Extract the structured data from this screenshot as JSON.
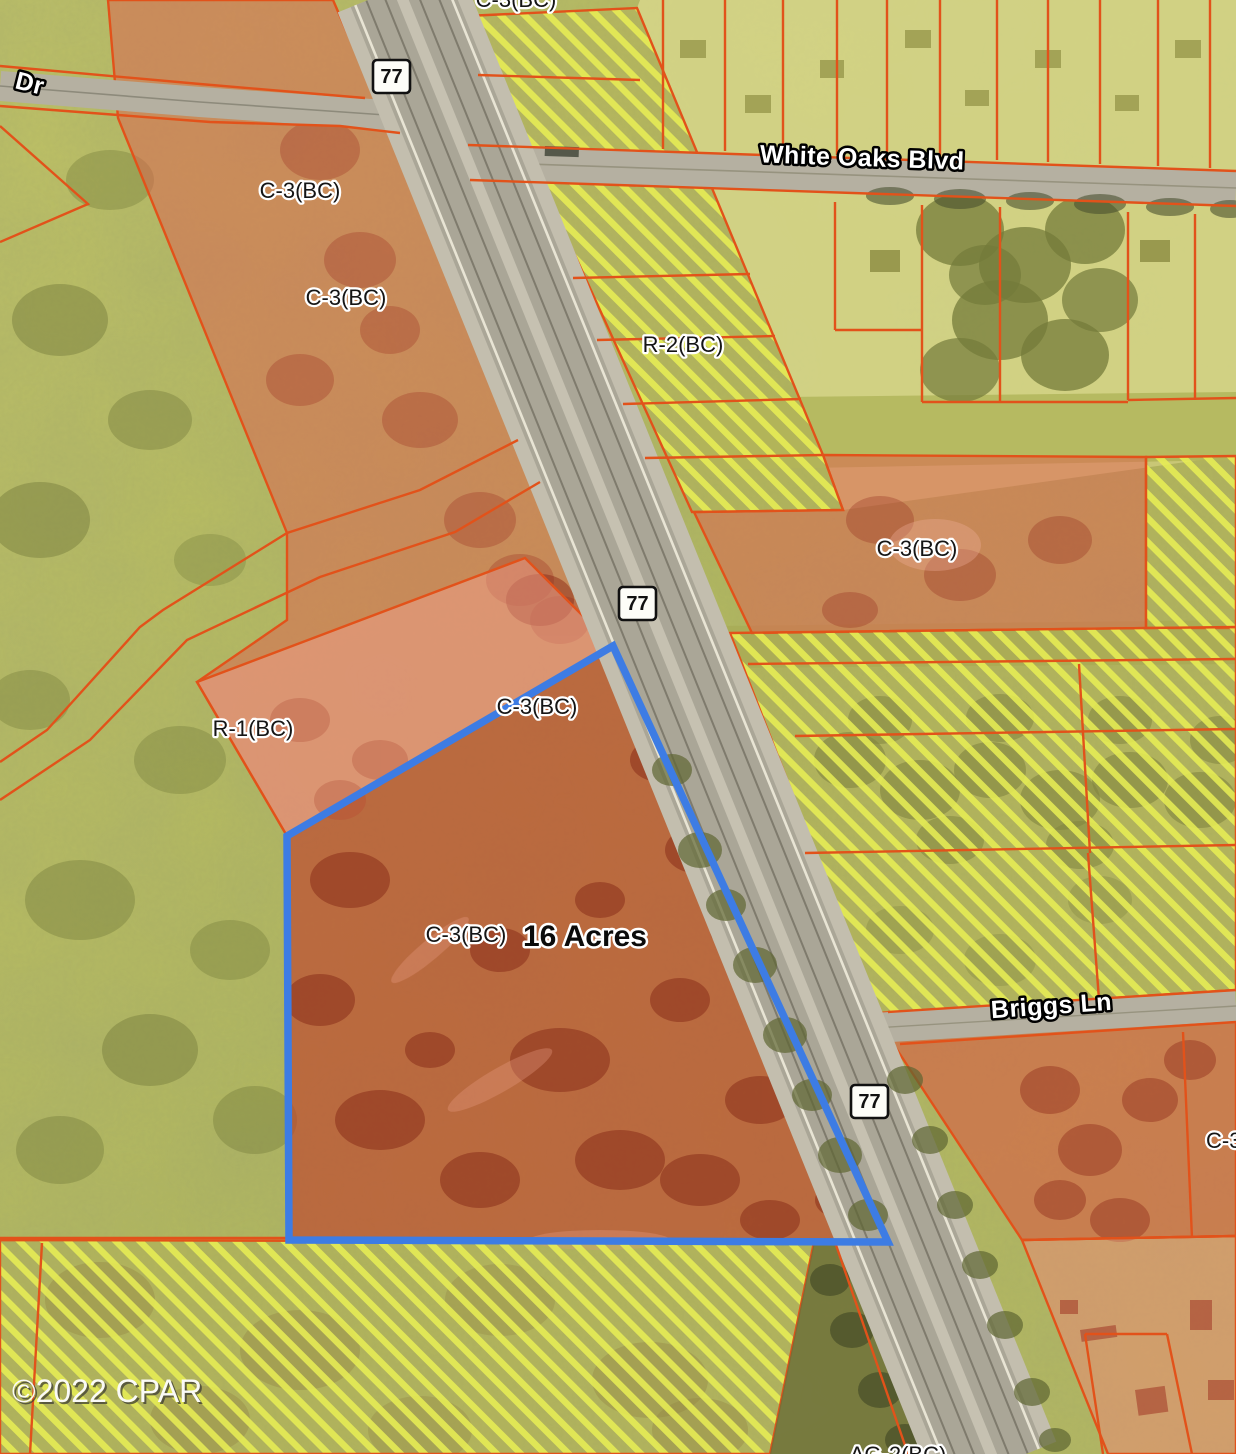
{
  "map": {
    "attribution": "©2022 CPAR",
    "shield": "77",
    "parcel": {
      "acreage": "16 Acres",
      "zoning": "C-3(BC)",
      "outline_color": "#3d7ce4"
    },
    "roads": {
      "highway": "77",
      "white_oaks": "White Oaks Blvd",
      "briggs": "Briggs Ln",
      "dr": "Dr"
    },
    "zones": {
      "c3": "C-3(BC)",
      "r2": "R-2(BC)",
      "r1": "R-1(BC)",
      "ag2": "AG-2(BC)"
    },
    "colors": {
      "parcel_outline": "#3d7ce4",
      "boundary_orange": "#e2521a",
      "commercial_red": "#dd6450",
      "subject_red": "#c0402c",
      "hatch_yellow": "#e9f055",
      "road_gray": "#b0ac9e"
    }
  }
}
